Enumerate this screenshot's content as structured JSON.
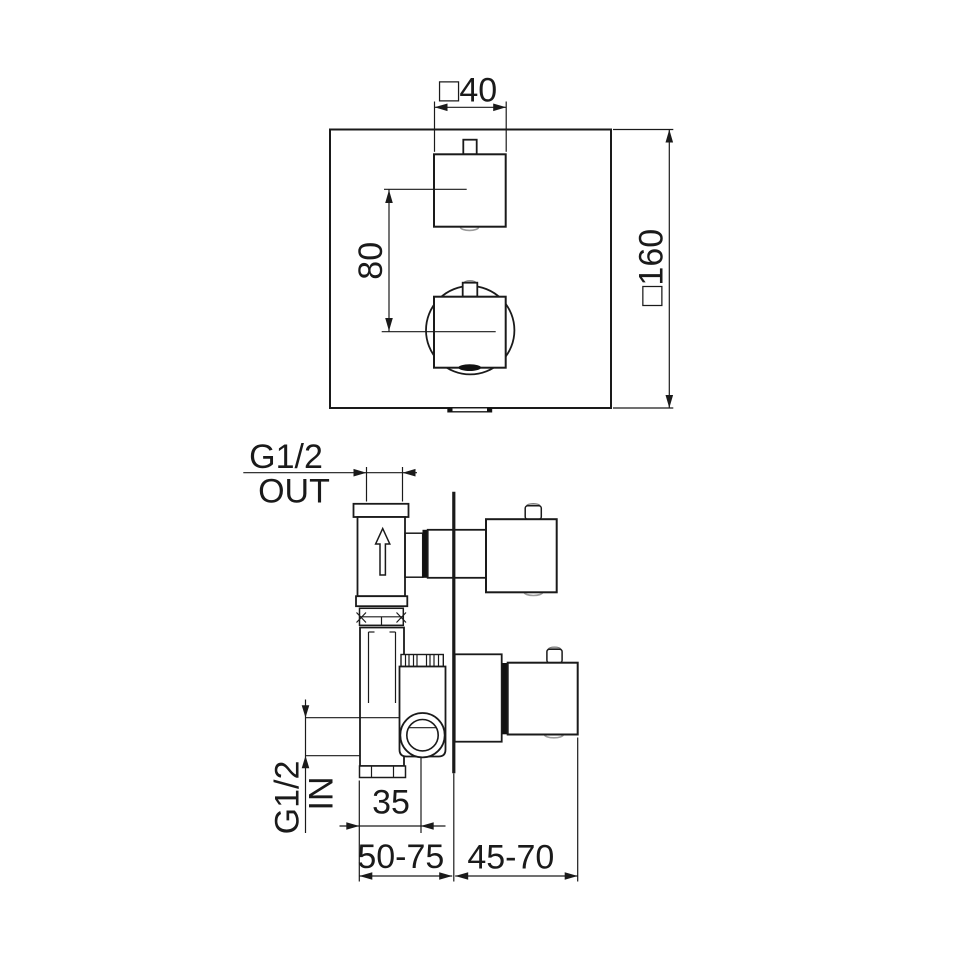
{
  "front_view": {
    "dim_handle_size": "□40",
    "dim_plate_size": "□160",
    "dim_handle_spacing": "80"
  },
  "side_view": {
    "outlet_thread": "G1/2",
    "outlet_direction": "OUT",
    "inlet_thread": "G1/2",
    "inlet_direction": "IN",
    "dim_inlet_offset": "35",
    "dim_mounting_depth": "50-75",
    "dim_trim_depth": "45-70"
  },
  "colors": {
    "line": "#1a1a1a",
    "background": "#ffffff",
    "accent_gray": "#b3b3b3"
  }
}
